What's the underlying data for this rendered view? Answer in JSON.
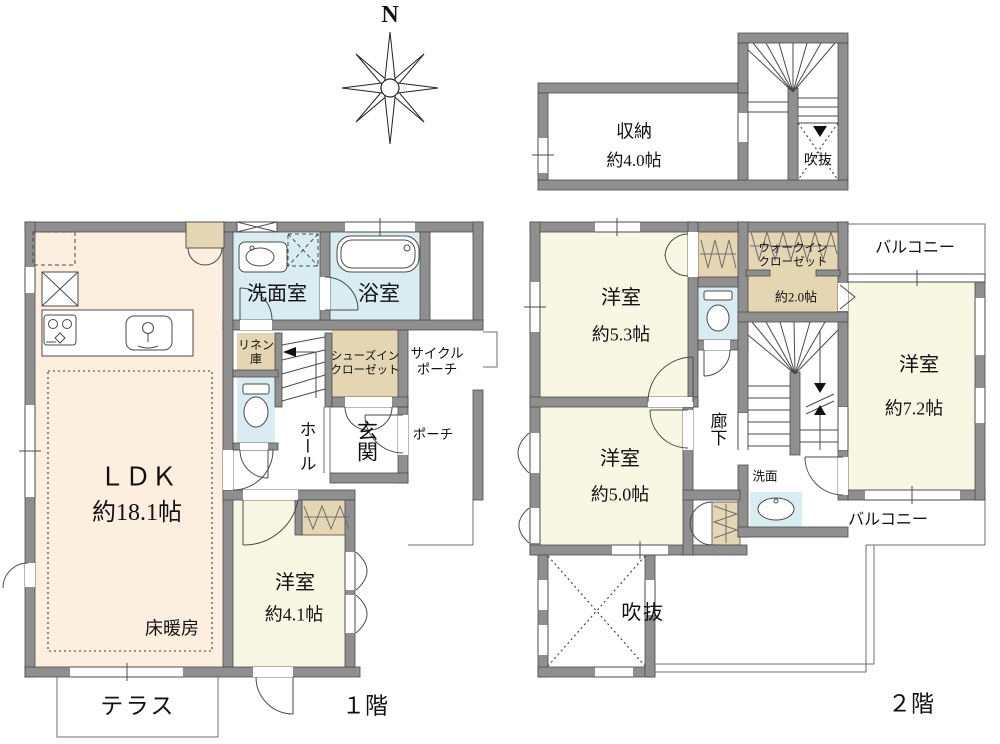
{
  "compass": {
    "north": "N"
  },
  "colors": {
    "wall": "#8f8f8f",
    "ldk_fill": "#fcefdf",
    "wet_fill": "#d9ecf2",
    "closet_fill": "#e4d6b2",
    "bedroom_fill": "#f7f7e3",
    "text": "#111111"
  },
  "floor1": {
    "label": "１階",
    "ldk": {
      "name": "ＬＤＫ",
      "size": "約18.1帖"
    },
    "floor_heating": "床暖房",
    "washroom": "洗面室",
    "bathroom": "浴室",
    "linen_closet": "リネン\n庫",
    "hall": "ホール",
    "shoes_closet": "シューズイン\nクローゼット",
    "entrance": "玄関",
    "cycle_porch": "サイクル\nポーチ",
    "porch": "ポーチ",
    "bedroom_41": {
      "name": "洋室",
      "size": "約4.1帖"
    },
    "terrace": "テラス"
  },
  "floor2": {
    "label": "２階",
    "storage": {
      "name": "収納",
      "size": "約4.0帖"
    },
    "void_upper": "吹抜",
    "bedroom_53": {
      "name": "洋室",
      "size": "約5.3帖"
    },
    "walk_in_closet": {
      "name": "ウォークイン\nクローゼット",
      "size": "約2.0帖"
    },
    "balcony_north": "バルコニー",
    "bedroom_72": {
      "name": "洋室",
      "size": "約7.2帖"
    },
    "corridor": "廊下",
    "washbasin": "洗面",
    "bedroom_50": {
      "name": "洋室",
      "size": "約5.0帖"
    },
    "void_main": "吹抜",
    "balcony_south": "バルコニー"
  }
}
